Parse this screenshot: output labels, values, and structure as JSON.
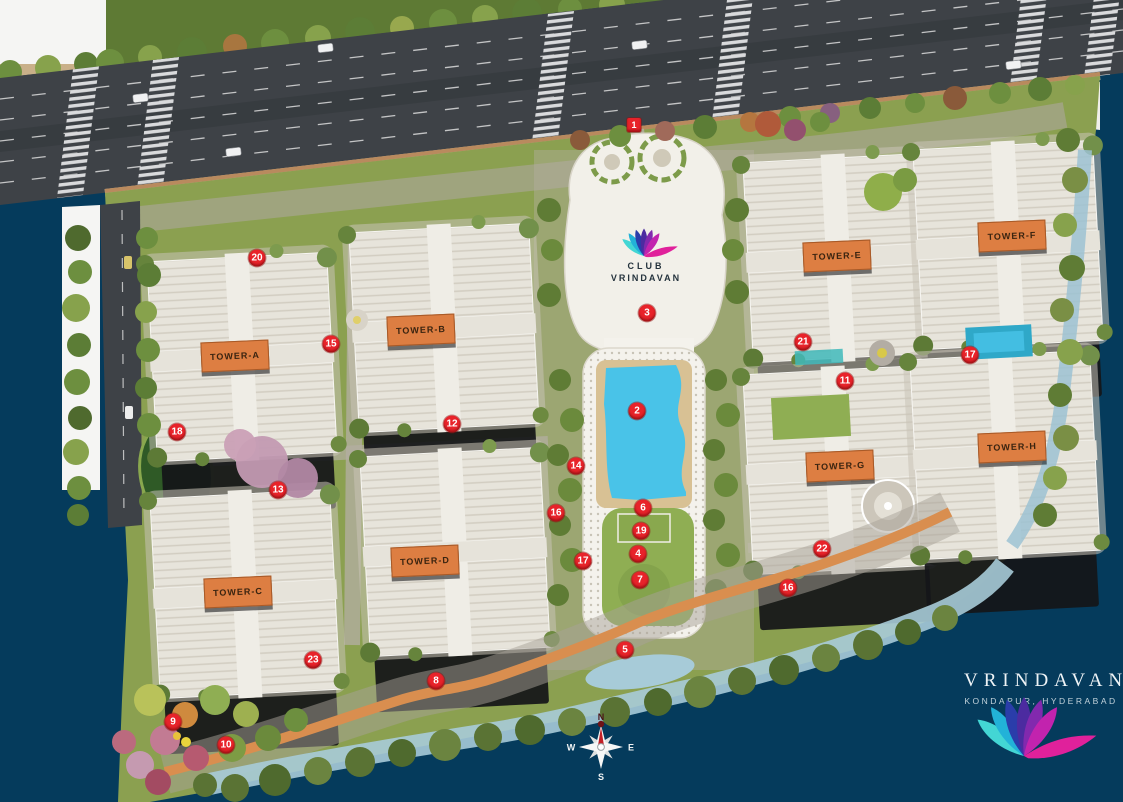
{
  "title": "Vrindavan Master Plan",
  "branding": {
    "name": "VRINDAVAN",
    "location": "KONDAPUR, HYDERABAD"
  },
  "club": {
    "line1": "CLUB",
    "line2": "VRINDAVAN"
  },
  "compass": {
    "north": "N",
    "south": "S",
    "east": "E",
    "west": "W"
  },
  "towers": [
    {
      "id": "a",
      "label": "TOWER-A",
      "x": 235,
      "y": 356
    },
    {
      "id": "b",
      "label": "TOWER-B",
      "x": 421,
      "y": 330
    },
    {
      "id": "c",
      "label": "TOWER-C",
      "x": 238,
      "y": 592
    },
    {
      "id": "d",
      "label": "TOWER-D",
      "x": 425,
      "y": 561
    },
    {
      "id": "e",
      "label": "TOWER-E",
      "x": 837,
      "y": 256
    },
    {
      "id": "f",
      "label": "TOWER-F",
      "x": 1012,
      "y": 236
    },
    {
      "id": "g",
      "label": "TOWER-G",
      "x": 840,
      "y": 466
    },
    {
      "id": "h",
      "label": "TOWER-H",
      "x": 1012,
      "y": 447
    }
  ],
  "markers": [
    {
      "n": "1",
      "x": 634,
      "y": 125,
      "shape": "square"
    },
    {
      "n": "2",
      "x": 637,
      "y": 411
    },
    {
      "n": "3",
      "x": 647,
      "y": 313
    },
    {
      "n": "4",
      "x": 638,
      "y": 554
    },
    {
      "n": "5",
      "x": 625,
      "y": 650
    },
    {
      "n": "6",
      "x": 643,
      "y": 508
    },
    {
      "n": "7",
      "x": 640,
      "y": 580
    },
    {
      "n": "8",
      "x": 436,
      "y": 681
    },
    {
      "n": "9",
      "x": 173,
      "y": 722
    },
    {
      "n": "10",
      "x": 226,
      "y": 745
    },
    {
      "n": "11",
      "x": 845,
      "y": 381
    },
    {
      "n": "12",
      "x": 452,
      "y": 424
    },
    {
      "n": "13",
      "x": 278,
      "y": 490
    },
    {
      "n": "14",
      "x": 576,
      "y": 466
    },
    {
      "n": "15",
      "x": 331,
      "y": 344
    },
    {
      "n": "16",
      "x": 556,
      "y": 513
    },
    {
      "n": "16",
      "x": 788,
      "y": 588
    },
    {
      "n": "17",
      "x": 583,
      "y": 561
    },
    {
      "n": "17",
      "x": 970,
      "y": 355
    },
    {
      "n": "18",
      "x": 177,
      "y": 432
    },
    {
      "n": "19",
      "x": 641,
      "y": 531
    },
    {
      "n": "20",
      "x": 257,
      "y": 258
    },
    {
      "n": "21",
      "x": 803,
      "y": 342
    },
    {
      "n": "22",
      "x": 822,
      "y": 549
    },
    {
      "n": "23",
      "x": 313,
      "y": 660
    }
  ],
  "colors": {
    "background": "#053b5c",
    "marker": "#e8232a",
    "towerLabel": "#dd7e42",
    "pool": "#49c3e8",
    "track": "#d98e4f",
    "stream": "#a7cbd8",
    "road": "#3e4247",
    "siteGreen": "#8ba050",
    "clubRoof": "#f2f0e9",
    "logoPetals": [
      "#43d6d4",
      "#22b2d8",
      "#2a3daa",
      "#4c2ba0",
      "#8229ae",
      "#c223ae",
      "#e0219b"
    ]
  }
}
